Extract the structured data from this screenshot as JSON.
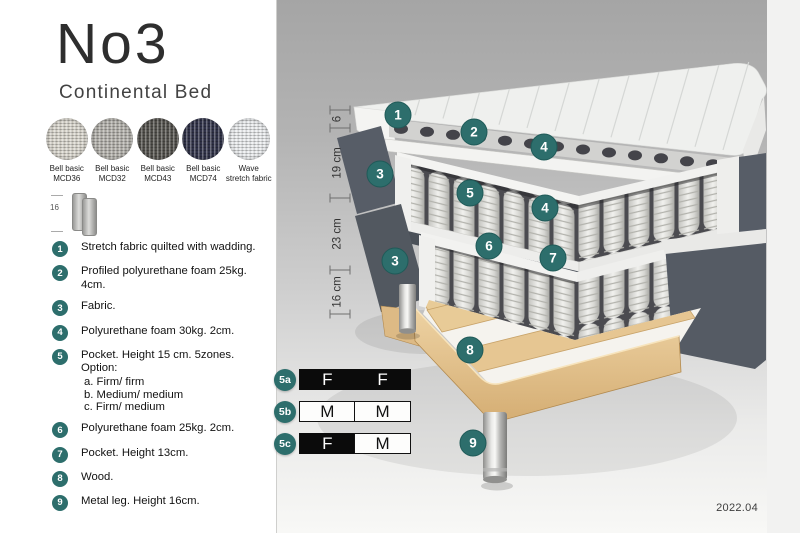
{
  "colors": {
    "accent_teal": "#2d6e6c",
    "page_bg": "#ffffff"
  },
  "header": {
    "title": "No3",
    "subtitle": "Continental Bed"
  },
  "swatches": [
    {
      "name": "Bell basic MCD36",
      "line1": "Bell basic",
      "line2": "MCD36",
      "color": "#dcd9d0"
    },
    {
      "name": "Bell basic MCD32",
      "line1": "Bell basic",
      "line2": "MCD32",
      "color": "#b6b4ae"
    },
    {
      "name": "Bell basic MCD43",
      "line1": "Bell basic",
      "line2": "MCD43",
      "color": "#56544f"
    },
    {
      "name": "Bell basic MCD74",
      "line1": "Bell basic",
      "line2": "MCD74",
      "color": "#32344b"
    },
    {
      "name": "Wave stretch fabric",
      "line1": "Wave",
      "line2": "stretch fabric",
      "color": "#eceef0"
    }
  ],
  "leg_icon": {
    "height_label": "16"
  },
  "legend": [
    {
      "num": "1",
      "text": "Stretch fabric quilted with wadding."
    },
    {
      "num": "2",
      "text": "Profiled polyurethane foam 25kg. 4cm."
    },
    {
      "num": "3",
      "text": "Fabric."
    },
    {
      "num": "4",
      "text": "Polyurethane foam 30kg. 2cm."
    },
    {
      "num": "5",
      "text": "Pocket. Height 15 cm. 5zones. Option:",
      "options": [
        "a. Firm/ firm",
        "b. Medium/ medium",
        "c. Firm/ medium"
      ]
    },
    {
      "num": "6",
      "text": "Polyurethane foam 25kg. 2cm."
    },
    {
      "num": "7",
      "text": "Pocket. Height 13cm."
    },
    {
      "num": "8",
      "text": "Wood."
    },
    {
      "num": "9",
      "text": "Metal leg. Height 16cm."
    }
  ],
  "diagram": {
    "dimensions": [
      {
        "label": "6"
      },
      {
        "label": "19 cm"
      },
      {
        "label": "23 cm"
      },
      {
        "label": "16 cm"
      }
    ],
    "callouts": [
      "1",
      "2",
      "4",
      "3",
      "5",
      "4",
      "6",
      "7",
      "3",
      "8",
      "9"
    ],
    "firmness_rows": [
      {
        "label": "5a",
        "cells": [
          {
            "text": "F",
            "style": "dark"
          },
          {
            "text": "F",
            "style": "dark"
          }
        ]
      },
      {
        "label": "5b",
        "cells": [
          {
            "text": "M",
            "style": "light"
          },
          {
            "text": "M",
            "style": "light"
          }
        ]
      },
      {
        "label": "5c",
        "cells": [
          {
            "text": "F",
            "style": "dark"
          },
          {
            "text": "M",
            "style": "light"
          }
        ]
      }
    ],
    "version": "2022.04"
  }
}
